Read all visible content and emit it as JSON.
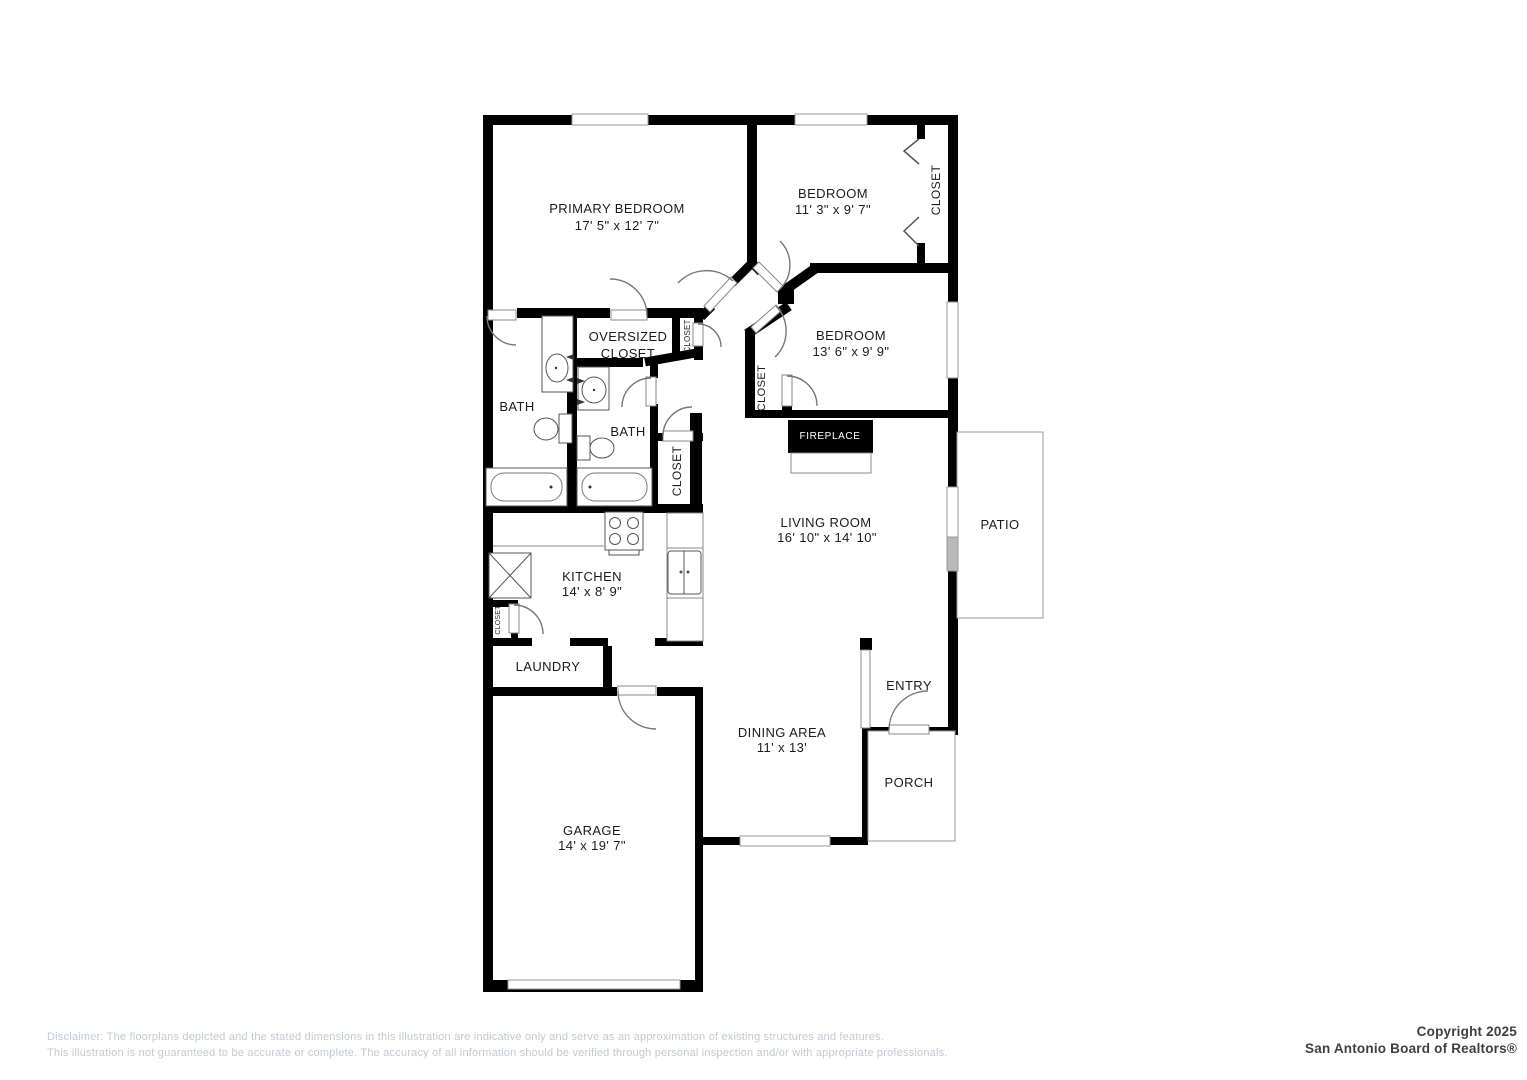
{
  "labels": {
    "primary_bedroom": {
      "name": "PRIMARY BEDROOM",
      "dims": "17' 5\" x 12' 7\""
    },
    "bedroom2": {
      "name": "BEDROOM",
      "dims": "11' 3\" x 9' 7\""
    },
    "bedroom3": {
      "name": "BEDROOM",
      "dims": "13' 6\" x 9' 9\""
    },
    "living_room": {
      "name": "LIVING ROOM",
      "dims": "16' 10\" x 14' 10\""
    },
    "kitchen": {
      "name": "KITCHEN",
      "dims": "14' x 8' 9\""
    },
    "dining_area": {
      "name": "DINING AREA",
      "dims": "11' x 13'"
    },
    "garage": {
      "name": "GARAGE",
      "dims": "14' x 19' 7\""
    },
    "oversized_closet": "OVERSIZED CLOSET",
    "bath1": "BATH",
    "bath2": "BATH",
    "laundry": "LAUNDRY",
    "entry": "ENTRY",
    "porch": "PORCH",
    "patio": "PATIO",
    "fireplace": "FIREPLACE",
    "closet_bedroom2": "CLOSET",
    "closet_bedroom3": "CLOSET",
    "closet_hall": "CLOSET",
    "closet_linen": "CLOSET",
    "closet_pantry": "CLOSET"
  },
  "footer": {
    "disclaimer_line1": "Disclaimer: The floorplans depicted and the stated dimensions in this illustration are indicative only and serve as an approximation of existing structures and features.",
    "disclaimer_line2": "This illustration is not guaranteed to be accurate or complete. The accuracy of all information should be verified through personal inspection and/or with appropriate professionals.",
    "copyright_line1": "Copyright 2025",
    "copyright_line2": "San Antonio Board of Realtors®"
  },
  "colors": {
    "wall": "#000000",
    "fixture": "#555555",
    "label": "#1b1b1b",
    "disclaimer": "#c4c8d6",
    "copyright": "#3f3f3f"
  }
}
